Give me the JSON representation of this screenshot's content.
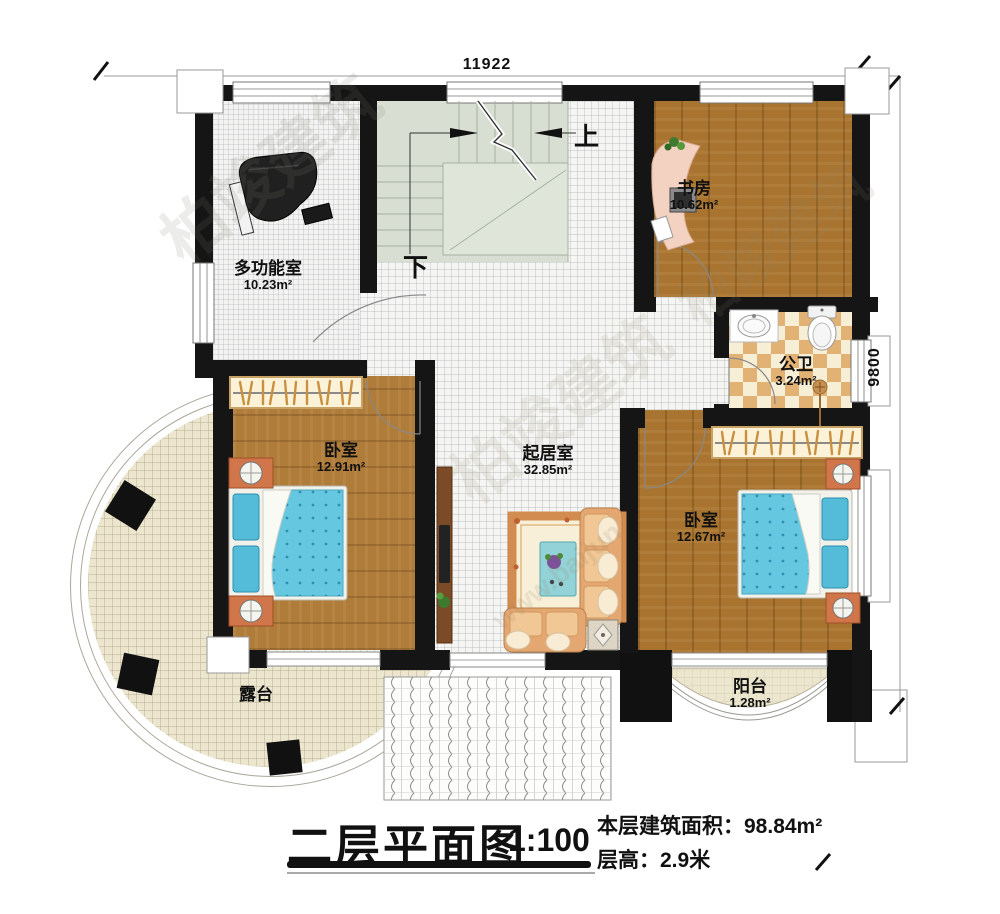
{
  "dimensions": {
    "width_label": "11922",
    "height_label": "9800"
  },
  "rooms": [
    {
      "name": "多功能室",
      "area": "10.23m²"
    },
    {
      "name": "书房",
      "area": "10.62m²"
    },
    {
      "name": "公卫",
      "area": "3.24m²"
    },
    {
      "name": "卧室",
      "area": "12.91m²"
    },
    {
      "name": "起居室",
      "area": "32.85m²"
    },
    {
      "name": "卧室",
      "area": "12.67m²"
    },
    {
      "name": "露台",
      "area": ""
    },
    {
      "name": "阳台",
      "area": "1.28m²"
    }
  ],
  "stairs": {
    "up": "上",
    "down": "下"
  },
  "watermark": {
    "brand": "柏竣建筑",
    "url": "www.baijun"
  },
  "title": {
    "name": "二层平面图",
    "scale": "1:100",
    "area_label": "本层建筑面积：",
    "area_value": "98.84m²",
    "height_label": "层高：",
    "height_value": "2.9米"
  },
  "colors": {
    "wall": "#151515",
    "wood": "#a9742f",
    "bed_blue": "#66c8e0",
    "checker_tan": "#e2b274",
    "sage": "#d8dfd2"
  }
}
